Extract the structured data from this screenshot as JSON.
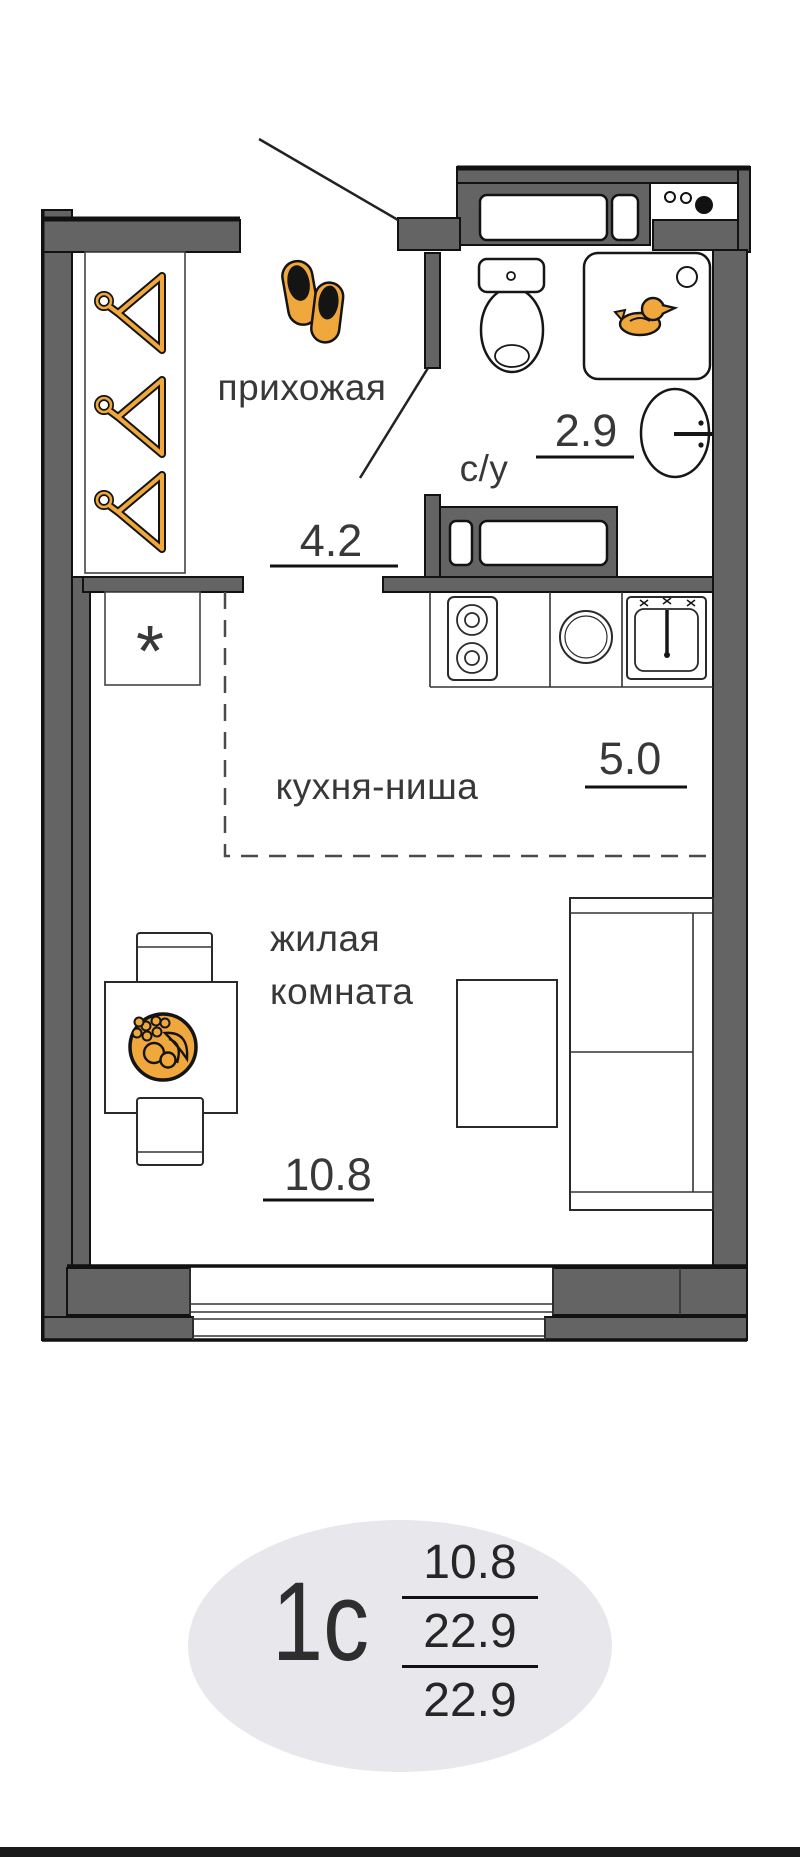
{
  "plan": {
    "rooms": [
      {
        "name": "прихожая",
        "area": "4.2"
      },
      {
        "name": "с/у",
        "area": "2.9"
      },
      {
        "name": "кухня-ниша",
        "area": "5.0"
      },
      {
        "name": "жилая комната",
        "line1": "жилая",
        "line2": "комната",
        "area": "10.8"
      }
    ],
    "fridge_symbol": "*"
  },
  "badge": {
    "unit_type": "1с",
    "living_area": "10.8",
    "middle_area": "22.9",
    "total_area": "22.9"
  },
  "colors": {
    "wall": "#646464",
    "outline": "#121212",
    "accent_orange": "#F0A73C",
    "badge_bg": "#E8E8EC",
    "label_text": "#383838"
  },
  "icons": {
    "hallway": [
      "hanger-icon",
      "slippers-icon"
    ],
    "bathroom": [
      "duck-icon"
    ],
    "living_room": [
      "fruit-bowl-icon"
    ]
  }
}
